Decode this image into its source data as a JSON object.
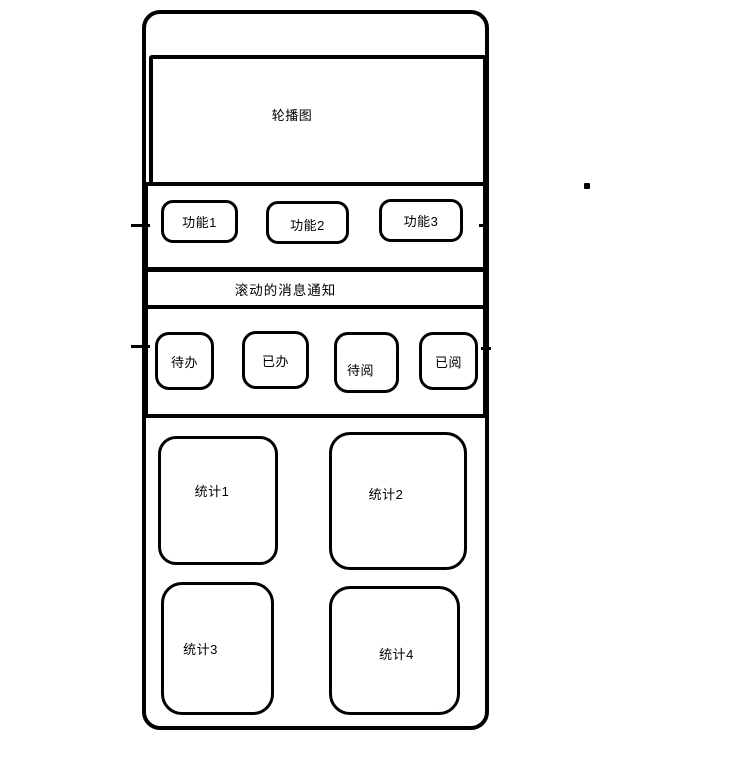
{
  "canvas": {
    "background": "#ffffff",
    "stroke_color": "#000000"
  },
  "wireframe": {
    "carousel": {
      "label": "轮播图"
    },
    "function_row": {
      "buttons": [
        {
          "label": "功能1"
        },
        {
          "label": "功能2"
        },
        {
          "label": "功能3"
        }
      ]
    },
    "notice_bar": {
      "label": "滚动的消息通知"
    },
    "task_row": {
      "buttons": [
        {
          "label": "待办"
        },
        {
          "label": "已办"
        },
        {
          "label": "待阅"
        },
        {
          "label": "已阅"
        }
      ]
    },
    "stats": {
      "cards": [
        {
          "label": "统计1"
        },
        {
          "label": "统计2"
        },
        {
          "label": "统计3"
        },
        {
          "label": "统计4"
        }
      ]
    }
  }
}
